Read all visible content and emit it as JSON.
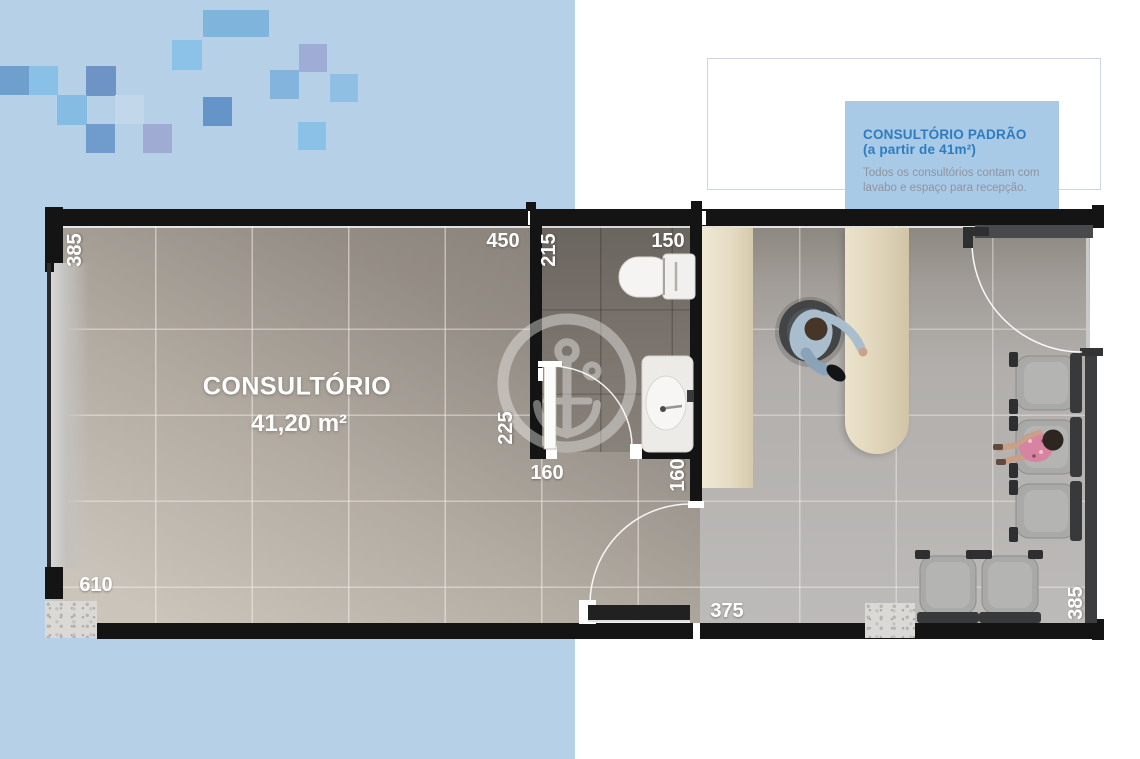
{
  "page": {
    "background": "#ffffff",
    "panel_blue": "#b6d0e8"
  },
  "decor": {
    "squares": [
      {
        "x": 203,
        "y": 10,
        "w": 66,
        "h": 27,
        "c": "#7fb4dc"
      },
      {
        "x": 172,
        "y": 40,
        "w": 30,
        "h": 30,
        "c": "#8cc2e7"
      },
      {
        "x": 299,
        "y": 44,
        "w": 28,
        "h": 28,
        "c": "#9fadd6"
      },
      {
        "x": 0,
        "y": 66,
        "w": 29,
        "h": 29,
        "c": "#6f9fcc"
      },
      {
        "x": 29,
        "y": 66,
        "w": 29,
        "h": 29,
        "c": "#89c0e6"
      },
      {
        "x": 86,
        "y": 66,
        "w": 30,
        "h": 30,
        "c": "#6e94c6"
      },
      {
        "x": 270,
        "y": 70,
        "w": 29,
        "h": 29,
        "c": "#82b4dd"
      },
      {
        "x": 330,
        "y": 74,
        "w": 28,
        "h": 28,
        "c": "#8fc0e4"
      },
      {
        "x": 57,
        "y": 95,
        "w": 30,
        "h": 30,
        "c": "#85bce4"
      },
      {
        "x": 115,
        "y": 95,
        "w": 29,
        "h": 29,
        "c": "#c3d7eb"
      },
      {
        "x": 203,
        "y": 97,
        "w": 29,
        "h": 29,
        "c": "#6594c8"
      },
      {
        "x": 86,
        "y": 124,
        "w": 29,
        "h": 29,
        "c": "#6f9ccb"
      },
      {
        "x": 143,
        "y": 124,
        "w": 29,
        "h": 29,
        "c": "#9fabd2"
      },
      {
        "x": 298,
        "y": 122,
        "w": 28,
        "h": 28,
        "c": "#8cc1e7"
      }
    ]
  },
  "info_box": {
    "title": "CONSULTÓRIO PADRÃO",
    "subtitle": "(a partir de 41m²)",
    "body_line1": "Todos os consultórios contam com",
    "body_line2": "lavabo e espaço para recepção.",
    "box_color": "#a9cae7",
    "title_color": "#2d7bc0",
    "body_color": "#8f939d"
  },
  "plan": {
    "room_name": "CONSULTÓRIO",
    "room_area": "41,20 m²",
    "dim_labels": [
      {
        "t": "385",
        "x": 75,
        "y": 250,
        "rot": -90
      },
      {
        "t": "450",
        "x": 503,
        "y": 241,
        "rot": 0
      },
      {
        "t": "215",
        "x": 549,
        "y": 250,
        "rot": -90
      },
      {
        "t": "150",
        "x": 668,
        "y": 241,
        "rot": 0
      },
      {
        "t": "225",
        "x": 506,
        "y": 428,
        "rot": -90
      },
      {
        "t": "160",
        "x": 547,
        "y": 473,
        "rot": 0
      },
      {
        "t": "160",
        "x": 678,
        "y": 475,
        "rot": -90
      },
      {
        "t": "610",
        "x": 96,
        "y": 585,
        "rot": 0
      },
      {
        "t": "375",
        "x": 727,
        "y": 611,
        "rot": 0
      },
      {
        "t": "385",
        "x": 1076,
        "y": 603,
        "rot": -90
      }
    ]
  }
}
